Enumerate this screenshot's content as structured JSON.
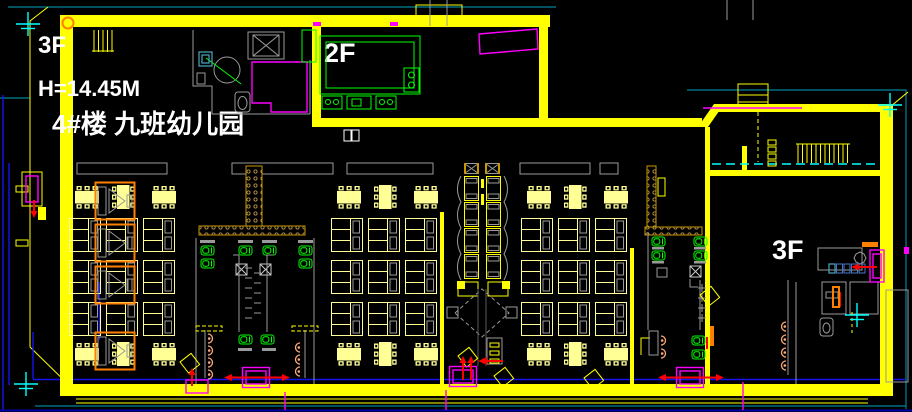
{
  "labels": {
    "floor_top_left": "3F",
    "height": "H=14.45M",
    "building": "4#楼 九班幼儿园",
    "floor_2f": "2F",
    "floor_3f_right": "3F"
  },
  "colors": {
    "bg": "#000000",
    "wall": "#FFFF00",
    "furn": "#FFFF96",
    "gray": "#9A9A9A",
    "dgray": "#5A5A5A",
    "green": "#00FF00",
    "magenta": "#FF00FF",
    "red": "#FF0000",
    "orange": "#FF8000",
    "peach": "#FFAA78",
    "cyan": "#00FFFF",
    "teal": "#00829B",
    "blue": "#1414EE",
    "navy": "#0000A8",
    "brass": "#C89600",
    "white": "#FFFFFF",
    "steel": "#4A78C8",
    "sky": "#49A8C0"
  }
}
